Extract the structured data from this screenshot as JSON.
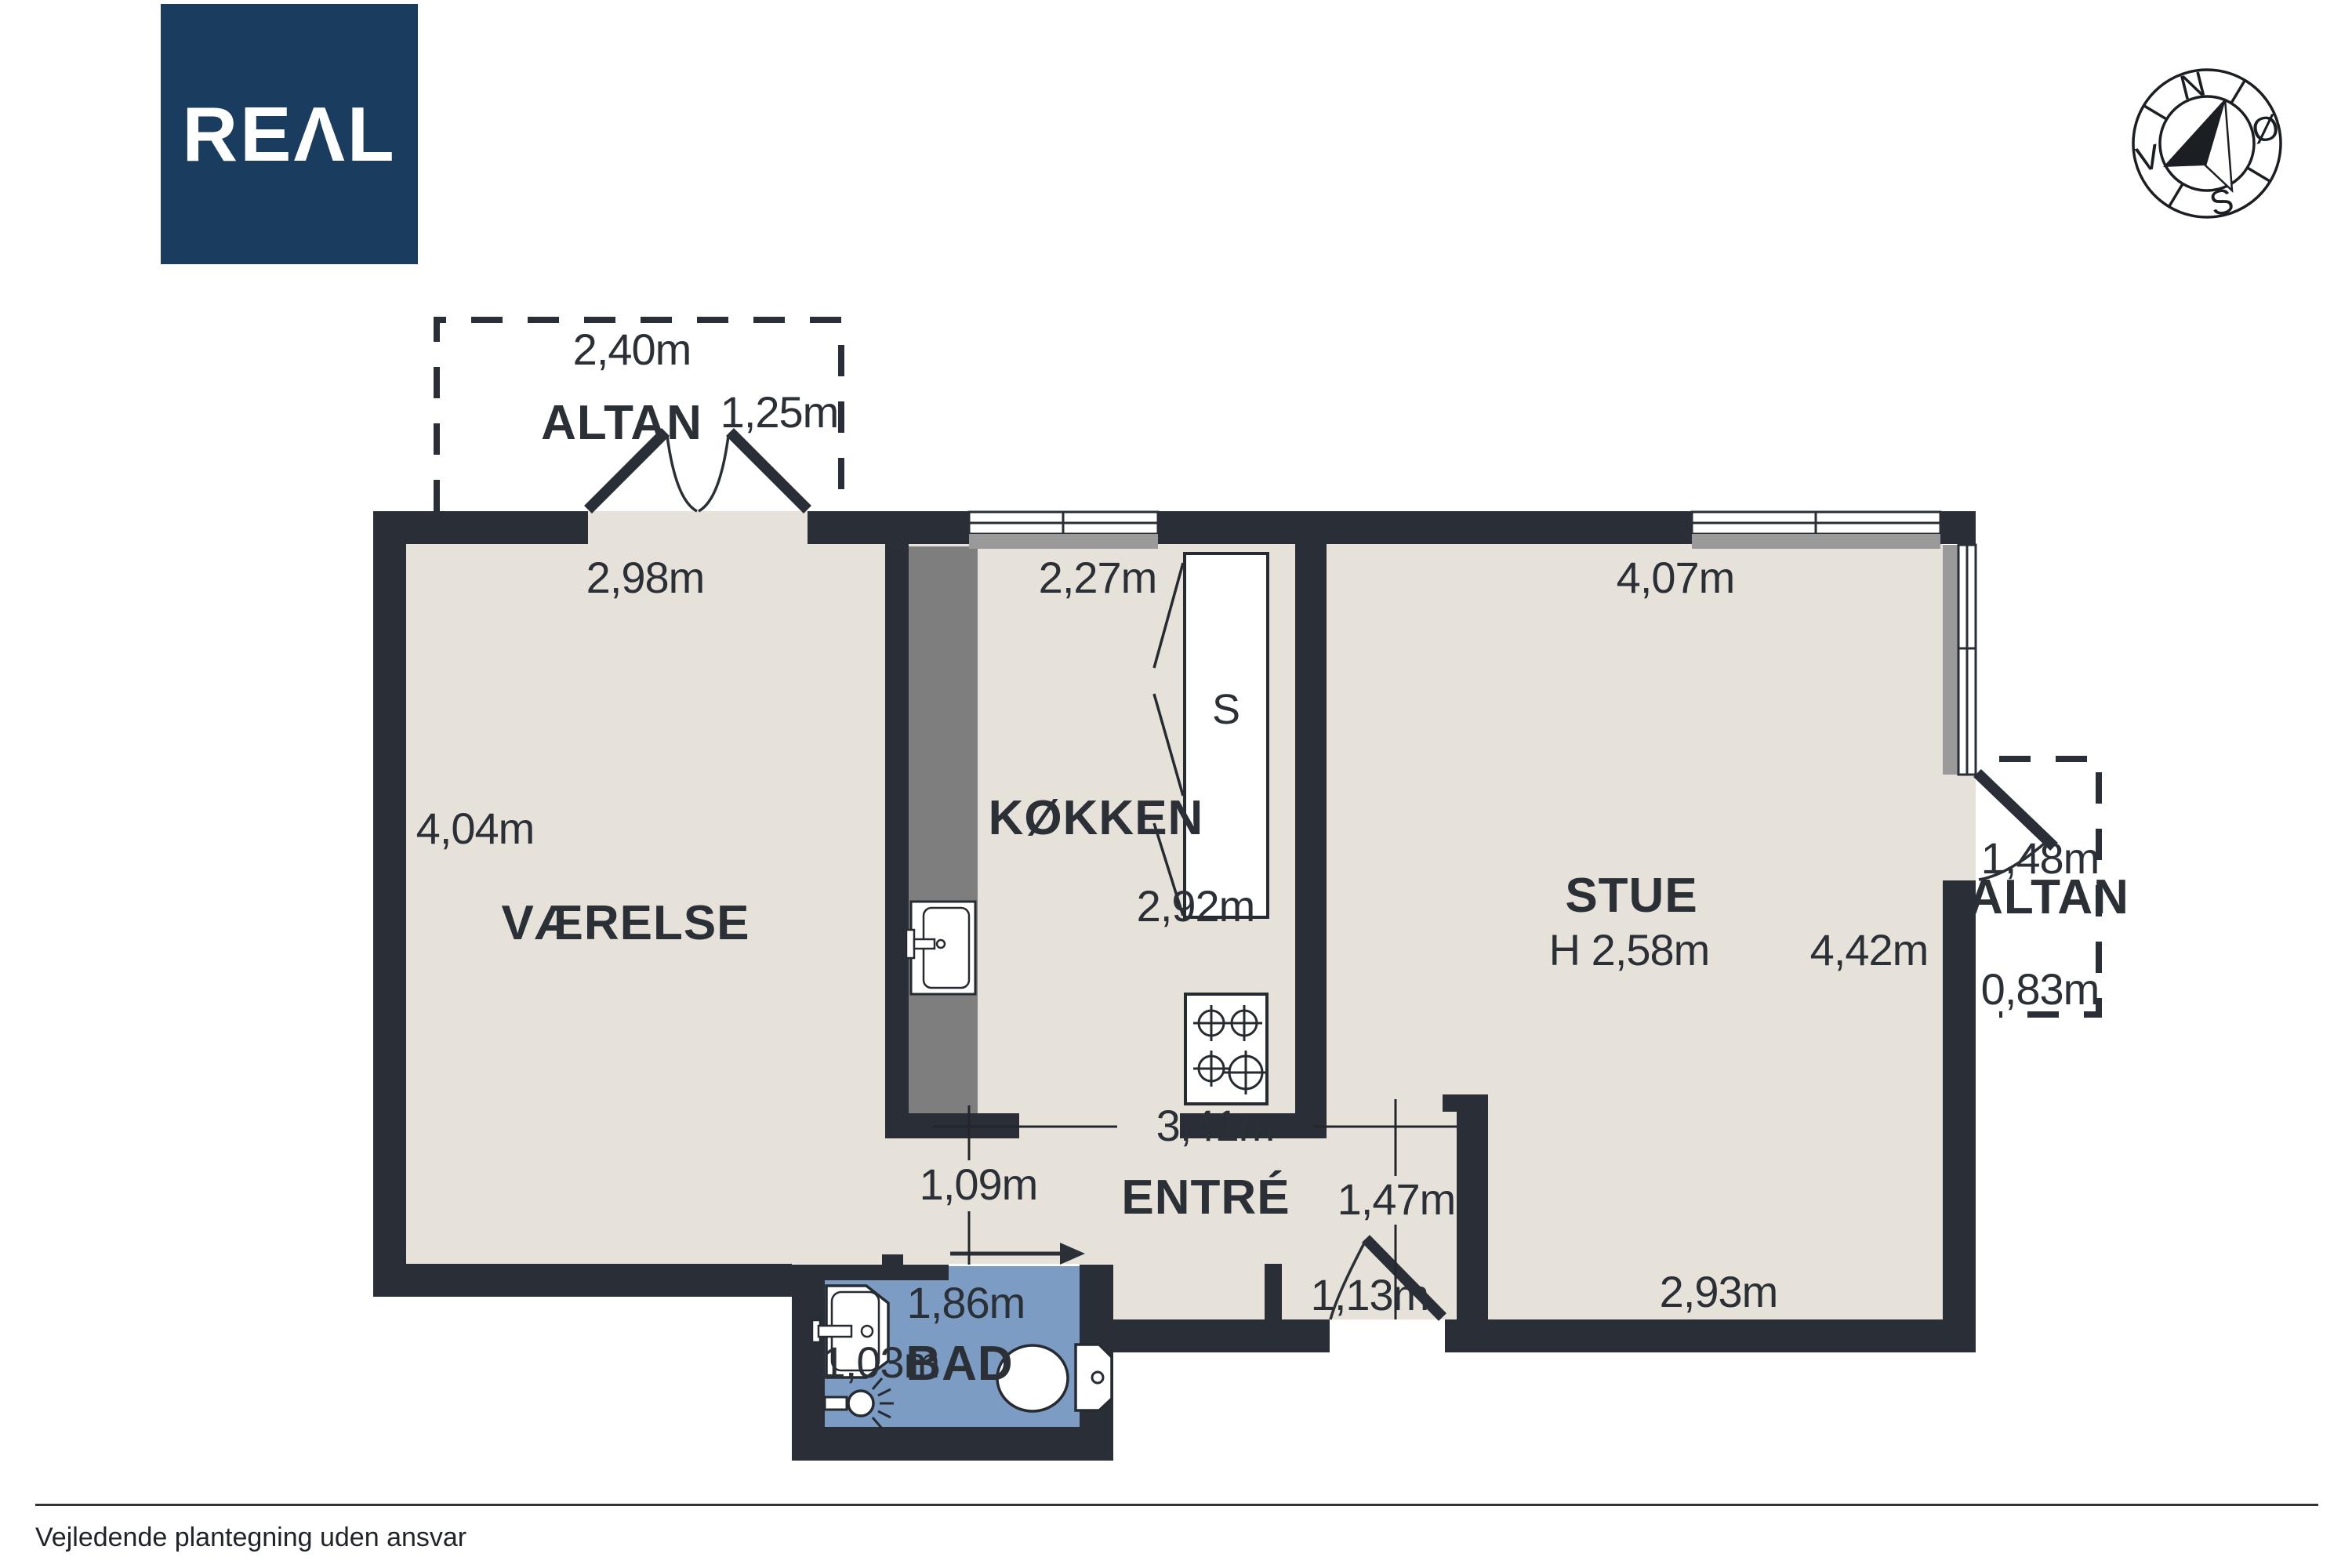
{
  "logo": {
    "brand": "REAL",
    "display": "REΛL",
    "bg_color": "#1a3c5e",
    "fg_color": "#ffffff"
  },
  "compass": {
    "n": "N",
    "oe": "Ø",
    "s": "S",
    "v": "V"
  },
  "rooms": {
    "altan_top": "ALTAN",
    "vaerelse": "VÆRELSE",
    "koekken": "KØKKEN",
    "closet": "S",
    "stue": "STUE",
    "entre": "ENTRÉ",
    "bad": "BAD",
    "altan_right": "ALTAN"
  },
  "dims": {
    "altan_top_width": "2,40m",
    "altan_top_door": "1,25m",
    "vaerelse_width": "2,98m",
    "koekken_width": "2,27m",
    "stue_width": "4,07m",
    "vaerelse_length": "4,04m",
    "koekken_length": "2,92m",
    "stue_ceiling": "H 2,58m",
    "stue_length": "4,42m",
    "altan_right_width": "1,48m",
    "altan_right_depth": "0,83m",
    "entre_width": "3,41m",
    "opening_vaerelse": "1,09m",
    "entre_wall": "1,47m",
    "entrance_door": "1,13m",
    "bad_width": "1,86m",
    "bad_length": "1,03m",
    "stue_bottom": "2,93m"
  },
  "footer": {
    "note": "Vejledende plantegning uden ansvar"
  },
  "colors": {
    "wall": "#2a2f37",
    "floor": "#e6e1d9",
    "bath_floor": "#7d9cc3",
    "counter_gray": "#7e7e7e",
    "window_sill_gray": "#9a9a9a",
    "logo_navy": "#1a3c5e",
    "ink": "#2b3037"
  },
  "icons": {
    "compass-icon": "compass rose with needle",
    "stove-icon": "4-burner cooktop",
    "kitchen-sink-icon": "kitchen sink with faucet",
    "washbasin-icon": "bathroom washbasin",
    "toilet-icon": "toilet with cistern",
    "shower-head-icon": "shower head with spray",
    "sliding-door-arrow-icon": "sliding door direction arrow",
    "door-swing-icon": "door leaf with swing arc",
    "window-icon": "double-pane window"
  }
}
